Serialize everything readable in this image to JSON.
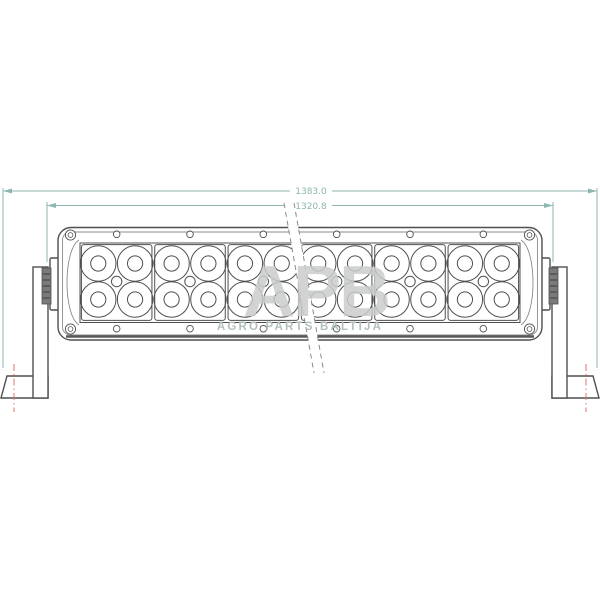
{
  "dimensions": {
    "overall_length_label": "1383.0",
    "inner_length_label": "1320.8"
  },
  "watermark": {
    "logo_text": "APB",
    "caption": "AGRO PARTS BALTIJA"
  },
  "structure": {
    "module_count": 6,
    "reflector_rows": 2,
    "reflector_cols_per_module": 2,
    "reflectors_total": 24
  },
  "colors": {
    "background": "#ffffff",
    "line": "#4f4f4f",
    "line_light": "#8a8a8a",
    "thick_edge": "#5a5a5a",
    "dimension": "#8cb6af",
    "centerline": "#e2756a",
    "knurl": "#7a7a7a",
    "knurl_dark": "#3d3d3d",
    "watermark_logo": "#c9cccb",
    "watermark_caption": "#b2c0bb"
  }
}
